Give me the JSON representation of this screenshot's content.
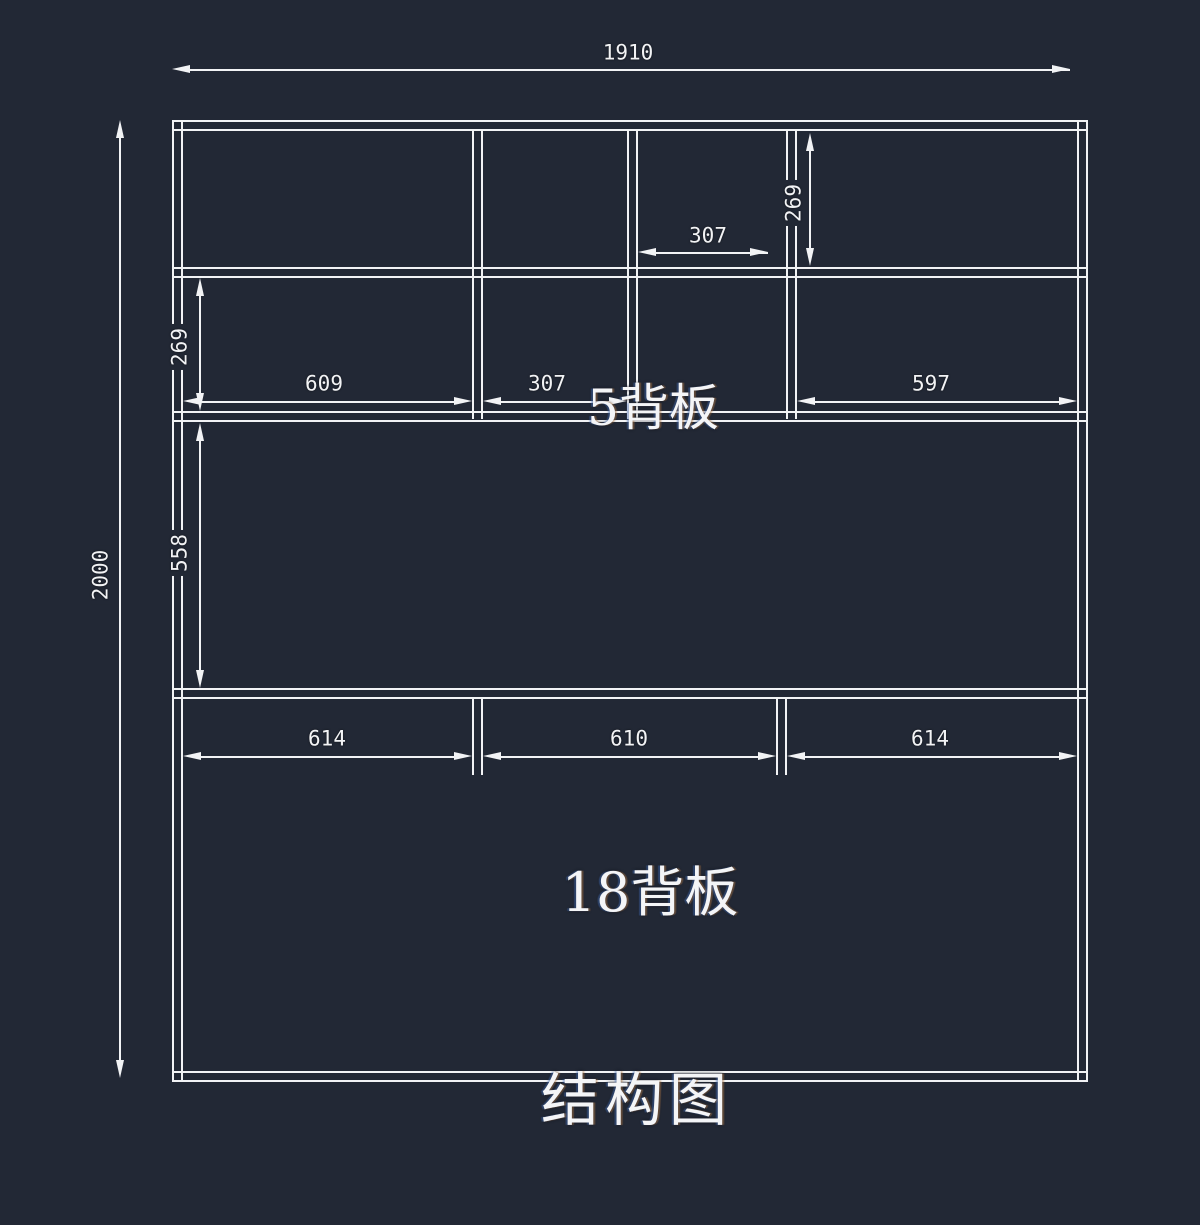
{
  "colors": {
    "background": "#222835",
    "line": "#f2f3f5"
  },
  "labels": {
    "upper_back_panel": "5背板",
    "lower_back_panel": "18背板",
    "drawing_title": "结构图"
  },
  "dims": {
    "overall_width": "1910",
    "overall_height": "2000",
    "top_row_cell_width": "307",
    "top_row_height": "269",
    "second_row_height": "269",
    "second_row_left_width": "609",
    "second_row_mid_width": "307",
    "second_row_right_width": "597",
    "middle_section_height": "558",
    "bottom_left_width": "614",
    "bottom_mid_width": "610",
    "bottom_right_width": "614"
  }
}
